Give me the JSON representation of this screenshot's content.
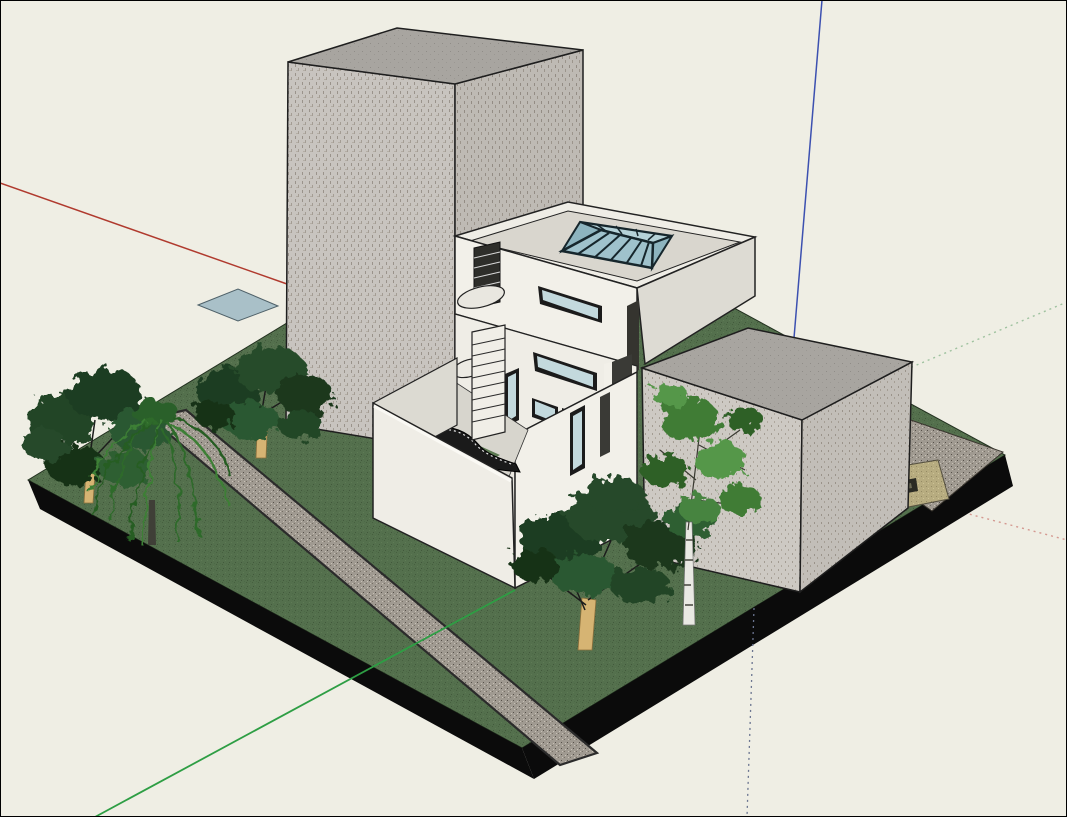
{
  "viewport": {
    "type": "3d-model-viewport",
    "app_style": "SketchUp-like architectural model view",
    "width": 1067,
    "height": 817,
    "scene": "Modern white villa with rooftop glass skylight and walled courtyard with exterior stairs, flanked by a tall speckled-concrete tower and a concrete cube building, on a rectangular lawn slab with gravel path, gravel drive, door mat, a glass panel on the ground, five trees, and modeling axes (red, green, blue; solid toward viewer, dotted away)"
  },
  "colors": {
    "background": "#EFEEE4",
    "frame_border": "#000000",
    "axis_red": "#B03A2E",
    "axis_red_dotted": "#D49890",
    "axis_green": "#2E9E44",
    "axis_green_dotted": "#9FC29F",
    "axis_blue": "#3C50B0",
    "axis_blue_dotted": "#6B7590",
    "grass": "#54704D",
    "grass_dot_dark": "#46603F",
    "grass_dot_light": "#5E7B55",
    "slab_side": "#0B0B0B",
    "gravel": "#A09A91",
    "khaki_mat": "#B7AC80",
    "mat_object_dark": "#2B2B24",
    "mat_object_light": "#6B6A55",
    "tower_wall": "#C8C4BF",
    "tower_wall_shade": "#BEBAB4",
    "block_roof": "#A8A5A0",
    "cube_wall": "#CDC9C3",
    "cube_wall_shade": "#C2BEB8",
    "house_wall_bright": "#F2F0E9",
    "house_wall_mid": "#E9E7E0",
    "house_wall_shade": "#DDDBD3",
    "parapet": "#EFEDE6",
    "roof_deck": "#D9D6CE",
    "window_frame": "#1B1B1B",
    "window_glass": "#C3D9DD",
    "skylight_glass": "#9FC2CC",
    "skylight_glass_back": "#B5D2D8",
    "skylight_glass_side": "#8DB4BF",
    "skylight_frame": "#16262C",
    "courtyard_floor": "#D7D5CD",
    "courtyard_lawn": "#5C7A52",
    "courtyard_wall": "#EFEDE6",
    "courtyard_wall_side": "#DCDAD2",
    "stair_dark": "#1A1A1A",
    "stair_light": "#F0EEE7",
    "door_slot": "#3A3A36",
    "trunk_tan": "#D6B473",
    "trunk_white": "#E9E9E3",
    "trunk_dark": "#3F3F37",
    "foliage_dark": "#1D3D21",
    "foliage_mid": "#2C5830",
    "foliage_deep": "#183218",
    "foliage_light": "#3F7C35",
    "foliage_lighter": "#54974A",
    "willow_green": "#2F6B2B",
    "glass_panel": "#A9C0C8"
  },
  "entities": [
    {
      "name": "ground-slab",
      "label": "Lawn site slab with black extruded edge"
    },
    {
      "name": "gravel-path",
      "label": "Gravel path across lawn"
    },
    {
      "name": "gravel-drive",
      "label": "Gravel drive at right corner"
    },
    {
      "name": "door-mat",
      "label": "Khaki mat with dark object"
    },
    {
      "name": "glass-panel",
      "label": "Glass panel lying on ground"
    },
    {
      "name": "tower-building",
      "label": "Tall speckled concrete tower"
    },
    {
      "name": "cube-building",
      "label": "Speckled concrete cube building"
    },
    {
      "name": "house",
      "label": "White villa with pyramidal glass skylight"
    },
    {
      "name": "courtyard",
      "label": "Walled courtyard with curved stair and lawn patch"
    },
    {
      "name": "tree-broadleaf-1",
      "label": "Broadleaf tree (far left)"
    },
    {
      "name": "tree-willow",
      "label": "Weeping willow"
    },
    {
      "name": "tree-broadleaf-2",
      "label": "Broadleaf tree (left of tower)"
    },
    {
      "name": "tree-broadleaf-3",
      "label": "Broadleaf tree (front of house)"
    },
    {
      "name": "tree-birch",
      "label": "Birch tree (front of cube)"
    }
  ]
}
